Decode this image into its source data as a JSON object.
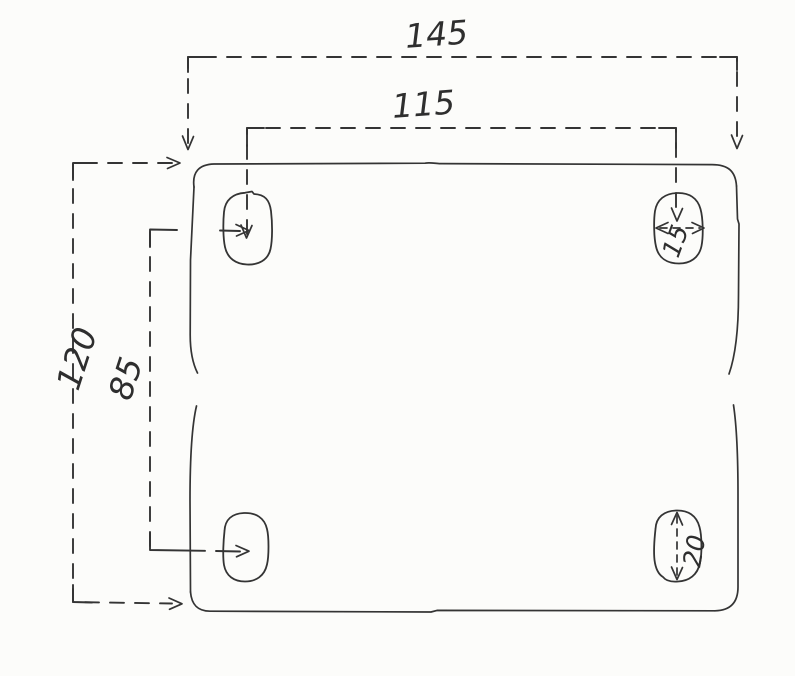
{
  "drawing": {
    "description": "Hand-drawn dimensioned sketch of a rectangular plate with four slotted mounting holes",
    "labels": {
      "width_outer": "145",
      "width_slots": "115",
      "height_outer": "120",
      "height_slots": "85",
      "slot_width": "15",
      "slot_length": "20"
    },
    "colors": {
      "ink": "#343434",
      "paper": "#fcfcfa"
    }
  }
}
